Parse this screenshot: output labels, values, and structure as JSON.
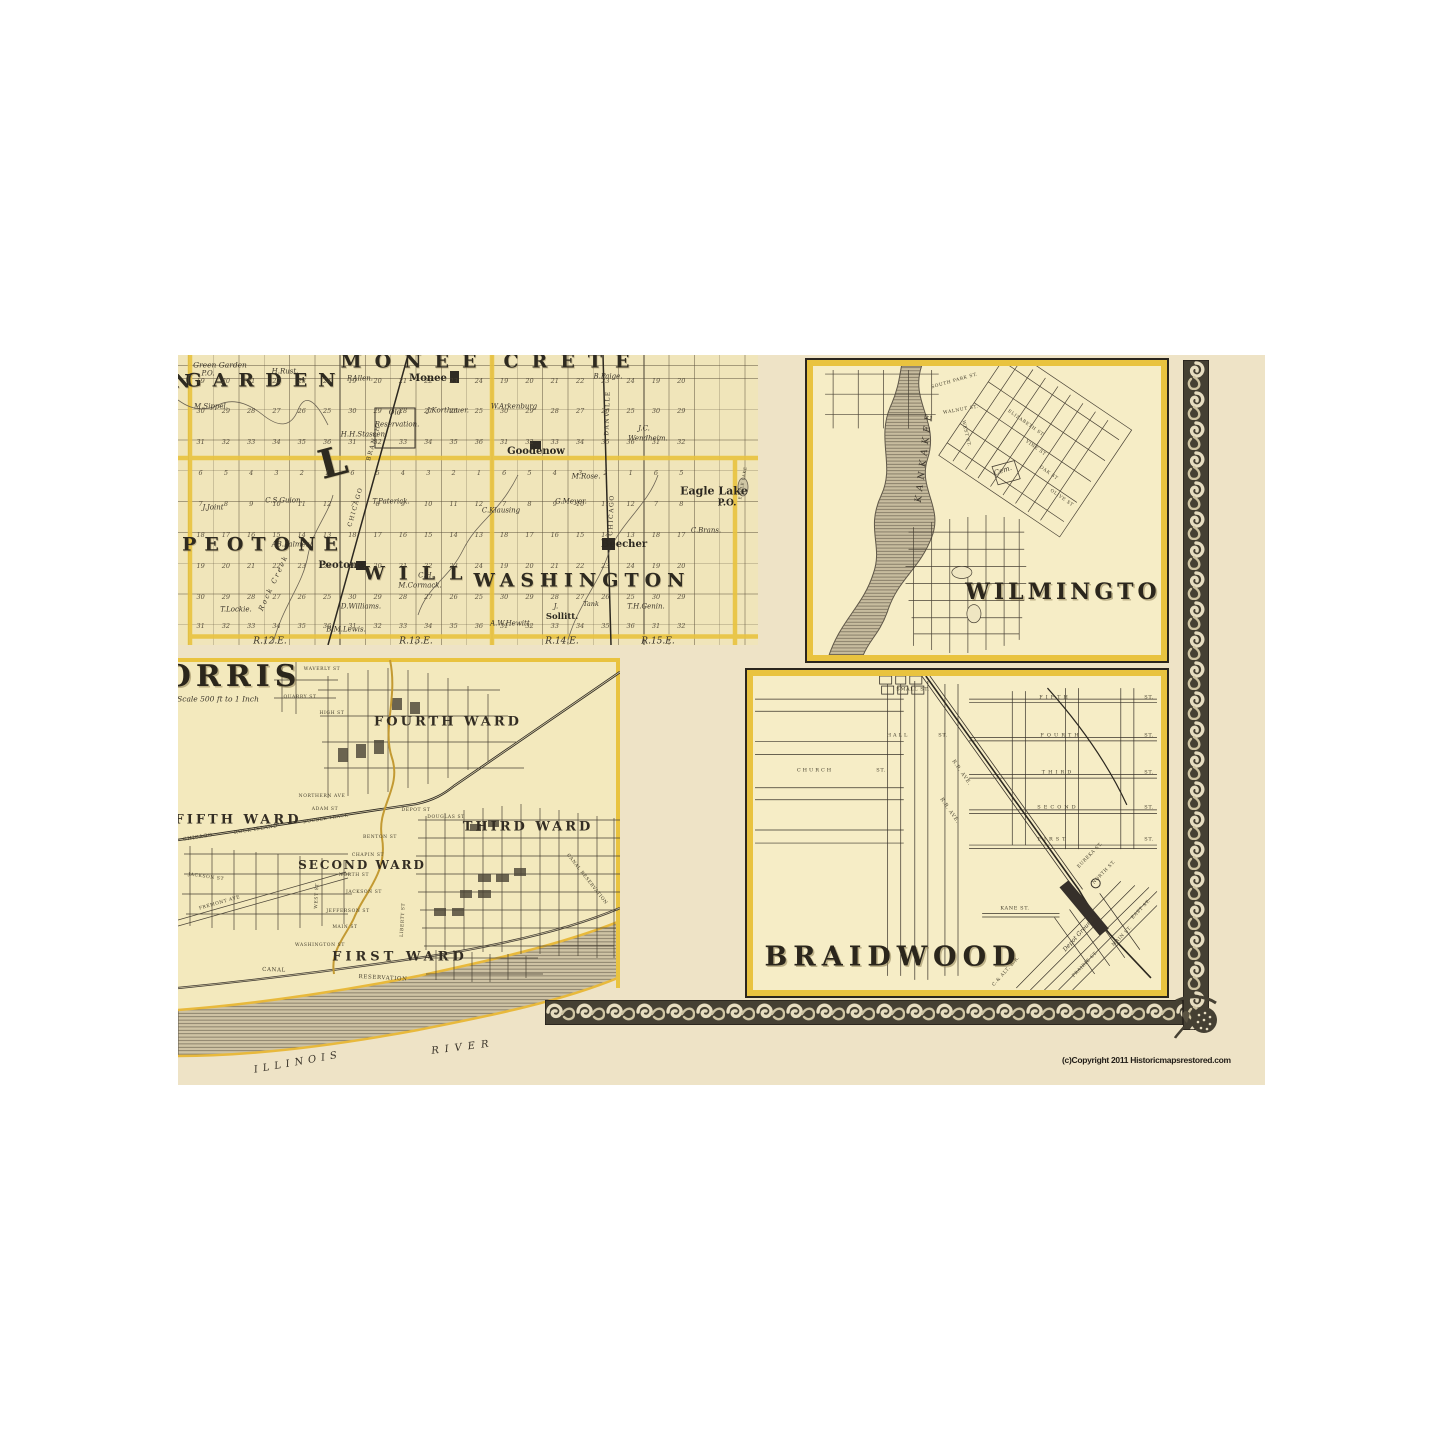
{
  "copyright": "(c)Copyright 2011 Historicmapsrestored.com",
  "colors": {
    "page_background": "#ffffff",
    "scan_cream": "#eee3c6",
    "plat_paper": "#f0e5ba",
    "inset_paper": "#f6edc6",
    "boundary_gold": "#e9c33f",
    "ink": "#2c271f",
    "border_band": "#454033"
  },
  "panels": {
    "township": {
      "description": "Township plat map of Will County townships",
      "townships": [
        "GREEN GARDEN",
        "MONEE",
        "CRETE",
        "PEOTONE",
        "WILL",
        "WASHINGTON"
      ],
      "range_labels": [
        "R.12.E.",
        "R.13.E.",
        "R.14.E.",
        "R.15.E."
      ],
      "sections": {
        "x0": 22.6,
        "dx": 25.3,
        "cols": 20,
        "rows_y": [
          26,
          56,
          87,
          118,
          149,
          180,
          211,
          242,
          271
        ],
        "pattern": [
          [
            19,
            20,
            21,
            22,
            23,
            24
          ],
          [
            30,
            29,
            28,
            27,
            26,
            25
          ],
          [
            31,
            32,
            33,
            34,
            35,
            36
          ],
          [
            6,
            5,
            4,
            3,
            2,
            1
          ],
          [
            7,
            8,
            9,
            10,
            11,
            12
          ],
          [
            18,
            17,
            16,
            15,
            14,
            13
          ],
          [
            19,
            20,
            21,
            22,
            23,
            24
          ],
          [
            30,
            29,
            28,
            27,
            26,
            25
          ],
          [
            31,
            32,
            33,
            34,
            35,
            36
          ]
        ]
      },
      "labels": [
        {
          "t": "GARDEN",
          "x": 88,
          "y": 26,
          "s": 19,
          "ls": 11,
          "c": "twp"
        },
        {
          "t": "N",
          "x": 4,
          "y": 27,
          "s": 19,
          "c": "twp"
        },
        {
          "t": "MONEE",
          "x": 237,
          "y": 7,
          "s": 19,
          "ls": 13,
          "c": "twp"
        },
        {
          "t": "CRETE",
          "x": 395,
          "y": 7,
          "s": 19,
          "ls": 13,
          "c": "twp"
        },
        {
          "t": "PEOTONE",
          "x": 86,
          "y": 190,
          "s": 19,
          "ls": 8,
          "c": "twp"
        },
        {
          "t": "WILL",
          "x": 242,
          "y": 219,
          "s": 19,
          "ls": 14,
          "c": "twp"
        },
        {
          "t": "WASHINGTON",
          "x": 404,
          "y": 226,
          "s": 19,
          "ls": 6,
          "c": "twp"
        },
        {
          "t": "L",
          "x": 155,
          "y": 108,
          "s": 40,
          "r": -15,
          "c": "twp"
        },
        {
          "t": "Monee",
          "x": 250,
          "y": 24,
          "s": 10,
          "c": "town"
        },
        {
          "t": "Goodenow",
          "x": 358,
          "y": 97,
          "s": 10,
          "c": "town"
        },
        {
          "t": "Peotone",
          "x": 163,
          "y": 211,
          "s": 10,
          "c": "town"
        },
        {
          "t": "Beecher",
          "x": 446,
          "y": 190,
          "s": 10,
          "c": "town"
        },
        {
          "t": "Eagle Lake",
          "x": 536,
          "y": 136,
          "s": 11,
          "c": "town"
        },
        {
          "t": "P.O.",
          "x": 549,
          "y": 149,
          "s": 9,
          "c": "town"
        },
        {
          "t": "Sollitt.",
          "x": 384,
          "y": 262,
          "s": 8.5,
          "c": "town"
        },
        {
          "t": "Green Garden",
          "x": 42,
          "y": 10,
          "s": 7.5,
          "c": "name"
        },
        {
          "t": "P.O.",
          "x": 30,
          "y": 19,
          "s": 7,
          "c": "name"
        },
        {
          "t": "H.Rust.",
          "x": 107,
          "y": 17,
          "s": 7,
          "c": "name"
        },
        {
          "t": "P.Allen.",
          "x": 182,
          "y": 24,
          "s": 7,
          "c": "name"
        },
        {
          "t": "M.Sippel.",
          "x": 33,
          "y": 52,
          "s": 7,
          "c": "name"
        },
        {
          "t": "H.H.Stassen.",
          "x": 186,
          "y": 80,
          "s": 7,
          "c": "name"
        },
        {
          "t": "Old",
          "x": 217,
          "y": 58,
          "s": 7,
          "c": "name"
        },
        {
          "t": "Reservation.",
          "x": 219,
          "y": 70,
          "s": 7,
          "c": "name"
        },
        {
          "t": "J.Korthauer.",
          "x": 270,
          "y": 56,
          "s": 7,
          "c": "name"
        },
        {
          "t": "W.Arkenburg",
          "x": 336,
          "y": 52,
          "s": 7,
          "c": "name"
        },
        {
          "t": "B.Paige.",
          "x": 430,
          "y": 22,
          "s": 7,
          "c": "name"
        },
        {
          "t": "J.C.",
          "x": 466,
          "y": 74,
          "s": 7,
          "c": "name"
        },
        {
          "t": "Wendheim.",
          "x": 470,
          "y": 84,
          "s": 7,
          "c": "name"
        },
        {
          "t": "M.Rose.",
          "x": 408,
          "y": 122,
          "s": 7,
          "c": "name"
        },
        {
          "t": "C.S.Guion.",
          "x": 106,
          "y": 146,
          "s": 7,
          "c": "name"
        },
        {
          "t": "J.Joint",
          "x": 35,
          "y": 153,
          "s": 7,
          "c": "name"
        },
        {
          "t": "T.Paterick.",
          "x": 213,
          "y": 147,
          "s": 7,
          "c": "name"
        },
        {
          "t": "C.Klausing",
          "x": 323,
          "y": 156,
          "s": 7,
          "c": "name"
        },
        {
          "t": "G.Meyer.",
          "x": 393,
          "y": 147,
          "s": 7,
          "c": "name"
        },
        {
          "t": "C.Brans.",
          "x": 528,
          "y": 176,
          "s": 7,
          "c": "name"
        },
        {
          "t": "AB.Palmer.",
          "x": 113,
          "y": 190,
          "s": 7,
          "c": "name"
        },
        {
          "t": "C.H.",
          "x": 248,
          "y": 221,
          "s": 7,
          "c": "name"
        },
        {
          "t": "M.Cormack.",
          "x": 242,
          "y": 231,
          "s": 7,
          "c": "name"
        },
        {
          "t": "D.Williams.",
          "x": 183,
          "y": 252,
          "s": 7,
          "c": "name"
        },
        {
          "t": "T.Lockie.",
          "x": 58,
          "y": 255,
          "s": 7,
          "c": "name"
        },
        {
          "t": "Tank",
          "x": 413,
          "y": 249,
          "s": 6.5,
          "c": "name"
        },
        {
          "t": "J.",
          "x": 378,
          "y": 252,
          "s": 7,
          "c": "name"
        },
        {
          "t": "T.H.Genin.",
          "x": 468,
          "y": 252,
          "s": 7,
          "c": "name"
        },
        {
          "t": "B.M.Lewis.",
          "x": 168,
          "y": 275,
          "s": 7,
          "c": "name"
        },
        {
          "t": "A.W.Hewitt.",
          "x": 333,
          "y": 269,
          "s": 7,
          "c": "name"
        },
        {
          "t": "Rock Creek",
          "x": 96,
          "y": 228,
          "s": 7,
          "r": -65,
          "ls": 2,
          "c": "name"
        },
        {
          "t": "BRANCH",
          "x": 196,
          "y": 88,
          "s": 6,
          "r": -74,
          "c": "rr"
        },
        {
          "t": "CHICAGO",
          "x": 178,
          "y": 152,
          "s": 6,
          "r": -74,
          "c": "rr"
        },
        {
          "t": "DANVILLE",
          "x": 430,
          "y": 58,
          "s": 6,
          "r": -88,
          "c": "rr"
        },
        {
          "t": "CHICAGO",
          "x": 434,
          "y": 160,
          "s": 6,
          "r": -88,
          "c": "rr"
        },
        {
          "t": "EAGLE LAKE",
          "x": 565,
          "y": 128,
          "s": 4,
          "r": -80,
          "c": "tiny"
        },
        {
          "t": "R.12.E.",
          "x": 92,
          "y": 287,
          "s": 9,
          "c": "range"
        },
        {
          "t": "R.13.E.",
          "x": 238,
          "y": 287,
          "s": 9,
          "c": "range"
        },
        {
          "t": "R.14.E.",
          "x": 384,
          "y": 287,
          "s": 9,
          "c": "range"
        },
        {
          "t": "R.15.E.",
          "x": 480,
          "y": 287,
          "s": 9,
          "c": "range"
        }
      ]
    },
    "wilmington": {
      "title": "WILMINGTON",
      "labels": [
        {
          "t": "KANKAKEE",
          "x": 112,
          "y": 90,
          "s": 9,
          "r": -83,
          "ls": 5,
          "c": "water"
        },
        {
          "t": "Cem.",
          "x": 190,
          "y": 105,
          "s": 7,
          "r": -18,
          "c": "name"
        },
        {
          "t": "SOUTH PARK ST.",
          "x": 142,
          "y": 16,
          "s": 4.5,
          "r": -16,
          "c": "tiny"
        },
        {
          "t": "WALNUT ST.",
          "x": 148,
          "y": 45,
          "s": 4.5,
          "r": -10,
          "c": "tiny"
        },
        {
          "t": "WEST ST.",
          "x": 152,
          "y": 68,
          "s": 4.5,
          "r": 77,
          "c": "tiny"
        },
        {
          "t": "ELIZABETH ST",
          "x": 212,
          "y": 58,
          "s": 4.5,
          "r": 35,
          "c": "tiny"
        },
        {
          "t": "VINE ST",
          "x": 222,
          "y": 83,
          "s": 4.5,
          "r": 35,
          "c": "tiny"
        },
        {
          "t": "OAK ST",
          "x": 235,
          "y": 108,
          "s": 4.5,
          "r": 35,
          "c": "tiny"
        },
        {
          "t": "OLIVE ST",
          "x": 248,
          "y": 133,
          "s": 4.5,
          "r": 35,
          "c": "tiny"
        },
        {
          "t": "WILMINGTON",
          "x": 262,
          "y": 226,
          "s": 22,
          "ls": 4,
          "c": "big"
        }
      ]
    },
    "morris": {
      "title": "MORRIS",
      "scale_note": "Scale 500 ft to 1 Inch",
      "wards": [
        "FIRST WARD",
        "SECOND WARD",
        "THIRD WARD",
        "FOURTH WARD",
        "FIFTH WARD"
      ],
      "labels": [
        {
          "t": "MORRIS",
          "x": 36,
          "y": 19,
          "s": 30,
          "ls": 5,
          "c": "big"
        },
        {
          "t": "Scale 500 ft to 1 Inch",
          "x": 40,
          "y": 41,
          "s": 7.5,
          "c": "name"
        },
        {
          "t": "FOURTH WARD",
          "x": 270,
          "y": 64,
          "s": 13,
          "ls": 3,
          "c": "ward"
        },
        {
          "t": "FIFTH WARD",
          "x": 60,
          "y": 162,
          "s": 13,
          "ls": 3,
          "c": "ward"
        },
        {
          "t": "THIRD WARD",
          "x": 350,
          "y": 169,
          "s": 13,
          "ls": 3,
          "c": "ward"
        },
        {
          "t": "SECOND WARD",
          "x": 184,
          "y": 207,
          "s": 12,
          "ls": 2,
          "c": "ward"
        },
        {
          "t": "FIRST WARD",
          "x": 222,
          "y": 299,
          "s": 13,
          "ls": 4,
          "c": "ward"
        },
        {
          "t": "ILLINOIS",
          "x": 120,
          "y": 405,
          "s": 10,
          "ls": 5,
          "r": -10,
          "c": "water"
        },
        {
          "t": "RIVER",
          "x": 285,
          "y": 390,
          "s": 10,
          "ls": 6,
          "r": -7,
          "c": "water"
        },
        {
          "t": "CANAL",
          "x": 96,
          "y": 313,
          "s": 5.5,
          "r": 2,
          "c": "tiny"
        },
        {
          "t": "RESERVATION",
          "x": 205,
          "y": 321,
          "s": 5.5,
          "r": 3,
          "c": "tiny"
        },
        {
          "t": "CANAL RESERVATION",
          "x": 408,
          "y": 222,
          "s": 4.5,
          "r": 52,
          "c": "tiny"
        },
        {
          "t": "CHICAGO",
          "x": 20,
          "y": 180,
          "s": 5,
          "r": -9,
          "c": "tiny"
        },
        {
          "t": "ROCK ISLAND",
          "x": 78,
          "y": 172,
          "s": 5,
          "r": -9,
          "c": "tiny"
        },
        {
          "t": "DOUBLE TRACK",
          "x": 148,
          "y": 162,
          "s": 4.5,
          "r": -9,
          "c": "tiny"
        },
        {
          "t": "WAVERLY ST",
          "x": 144,
          "y": 12,
          "s": 4.5,
          "c": "tiny"
        },
        {
          "t": "QUARRY ST",
          "x": 122,
          "y": 40,
          "s": 4.5,
          "c": "tiny"
        },
        {
          "t": "HIGH ST",
          "x": 154,
          "y": 56,
          "s": 4.5,
          "c": "tiny"
        },
        {
          "t": "NORTHERN AVE",
          "x": 144,
          "y": 139,
          "s": 4.5,
          "c": "tiny"
        },
        {
          "t": "ADAM ST",
          "x": 147,
          "y": 152,
          "s": 4.5,
          "c": "tiny"
        },
        {
          "t": "DEPOT ST",
          "x": 238,
          "y": 153,
          "s": 4.5,
          "c": "tiny"
        },
        {
          "t": "DOUGLAS ST",
          "x": 268,
          "y": 160,
          "s": 4.5,
          "c": "tiny"
        },
        {
          "t": "BENTON ST",
          "x": 202,
          "y": 180,
          "s": 4.5,
          "c": "tiny"
        },
        {
          "t": "CHAPIN ST",
          "x": 190,
          "y": 198,
          "s": 4.5,
          "c": "tiny"
        },
        {
          "t": "NORTH ST",
          "x": 176,
          "y": 218,
          "s": 4.5,
          "c": "tiny"
        },
        {
          "t": "JACKSON ST",
          "x": 186,
          "y": 235,
          "s": 4.5,
          "c": "tiny"
        },
        {
          "t": "JACKSON ST",
          "x": 28,
          "y": 220,
          "s": 4.5,
          "r": 8,
          "c": "tiny"
        },
        {
          "t": "JEFFERSON ST",
          "x": 170,
          "y": 254,
          "s": 4.5,
          "c": "tiny"
        },
        {
          "t": "MAIN ST",
          "x": 167,
          "y": 270,
          "s": 4.5,
          "c": "tiny"
        },
        {
          "t": "WASHINGTON ST",
          "x": 142,
          "y": 288,
          "s": 4.5,
          "c": "tiny"
        },
        {
          "t": "LIBERTY ST",
          "x": 226,
          "y": 262,
          "s": 4.5,
          "r": -87,
          "c": "tiny"
        },
        {
          "t": "WEST ST",
          "x": 140,
          "y": 238,
          "s": 4.5,
          "r": -87,
          "c": "tiny"
        },
        {
          "t": "FREMONT AVE",
          "x": 42,
          "y": 246,
          "s": 4.5,
          "r": -16,
          "c": "tiny"
        }
      ]
    },
    "braidwood": {
      "title": "BRAIDWOOD",
      "labels": [
        {
          "t": "SMALL ST.",
          "x": 160,
          "y": 14,
          "s": 5,
          "c": "tiny"
        },
        {
          "t": "FIFTH",
          "x": 302,
          "y": 22,
          "s": 5,
          "ls": 3,
          "c": "tiny"
        },
        {
          "t": "ST.",
          "x": 396,
          "y": 22,
          "s": 5,
          "c": "tiny"
        },
        {
          "t": "FOURTH",
          "x": 308,
          "y": 60,
          "s": 5,
          "ls": 3,
          "c": "tiny"
        },
        {
          "t": "ST.",
          "x": 396,
          "y": 60,
          "s": 5,
          "c": "tiny"
        },
        {
          "t": "THIRD",
          "x": 305,
          "y": 97,
          "s": 5,
          "ls": 3,
          "c": "tiny"
        },
        {
          "t": "ST.",
          "x": 396,
          "y": 97,
          "s": 5,
          "c": "tiny"
        },
        {
          "t": "SECOND",
          "x": 305,
          "y": 132,
          "s": 5,
          "ls": 3,
          "c": "tiny"
        },
        {
          "t": "ST.",
          "x": 396,
          "y": 132,
          "s": 5,
          "c": "tiny"
        },
        {
          "t": "FIRST",
          "x": 300,
          "y": 164,
          "s": 5,
          "ls": 3,
          "c": "tiny"
        },
        {
          "t": "ST.",
          "x": 396,
          "y": 164,
          "s": 5,
          "c": "tiny"
        },
        {
          "t": "HALL",
          "x": 145,
          "y": 60,
          "s": 5,
          "ls": 2,
          "c": "tiny"
        },
        {
          "t": "ST.",
          "x": 190,
          "y": 60,
          "s": 5,
          "c": "tiny"
        },
        {
          "t": "CHURCH",
          "x": 62,
          "y": 95,
          "s": 5,
          "ls": 2,
          "c": "tiny"
        },
        {
          "t": "ST.",
          "x": 128,
          "y": 95,
          "s": 5,
          "c": "tiny"
        },
        {
          "t": "R.R. AVE.",
          "x": 208,
          "y": 97,
          "s": 5,
          "r": 55,
          "c": "tiny"
        },
        {
          "t": "R.R. AVE.",
          "x": 196,
          "y": 135,
          "s": 5,
          "r": 55,
          "c": "tiny"
        },
        {
          "t": "KANE ST.",
          "x": 262,
          "y": 233,
          "s": 5,
          "c": "tiny"
        },
        {
          "t": "EUREKA ST.",
          "x": 338,
          "y": 180,
          "s": 4.5,
          "r": -46,
          "c": "tiny"
        },
        {
          "t": "NORTH ST.",
          "x": 352,
          "y": 197,
          "s": 4.5,
          "r": -46,
          "c": "tiny"
        },
        {
          "t": "Depot Grounds",
          "x": 327,
          "y": 258,
          "s": 6,
          "r": -48,
          "c": "name"
        },
        {
          "t": "C.& ALT. R.R.",
          "x": 254,
          "y": 296,
          "s": 4.5,
          "r": -48,
          "c": "tiny"
        },
        {
          "t": "PRAIRIE ST.",
          "x": 333,
          "y": 289,
          "s": 4.5,
          "r": -46,
          "c": "tiny"
        },
        {
          "t": "MAIN ST.",
          "x": 370,
          "y": 261,
          "s": 4.5,
          "r": -46,
          "c": "tiny"
        },
        {
          "t": "EAST ST.",
          "x": 389,
          "y": 234,
          "s": 4.5,
          "r": -46,
          "c": "tiny"
        },
        {
          "t": "BRAIDWOOD",
          "x": 140,
          "y": 281,
          "s": 27,
          "ls": 6,
          "c": "big"
        }
      ]
    }
  }
}
